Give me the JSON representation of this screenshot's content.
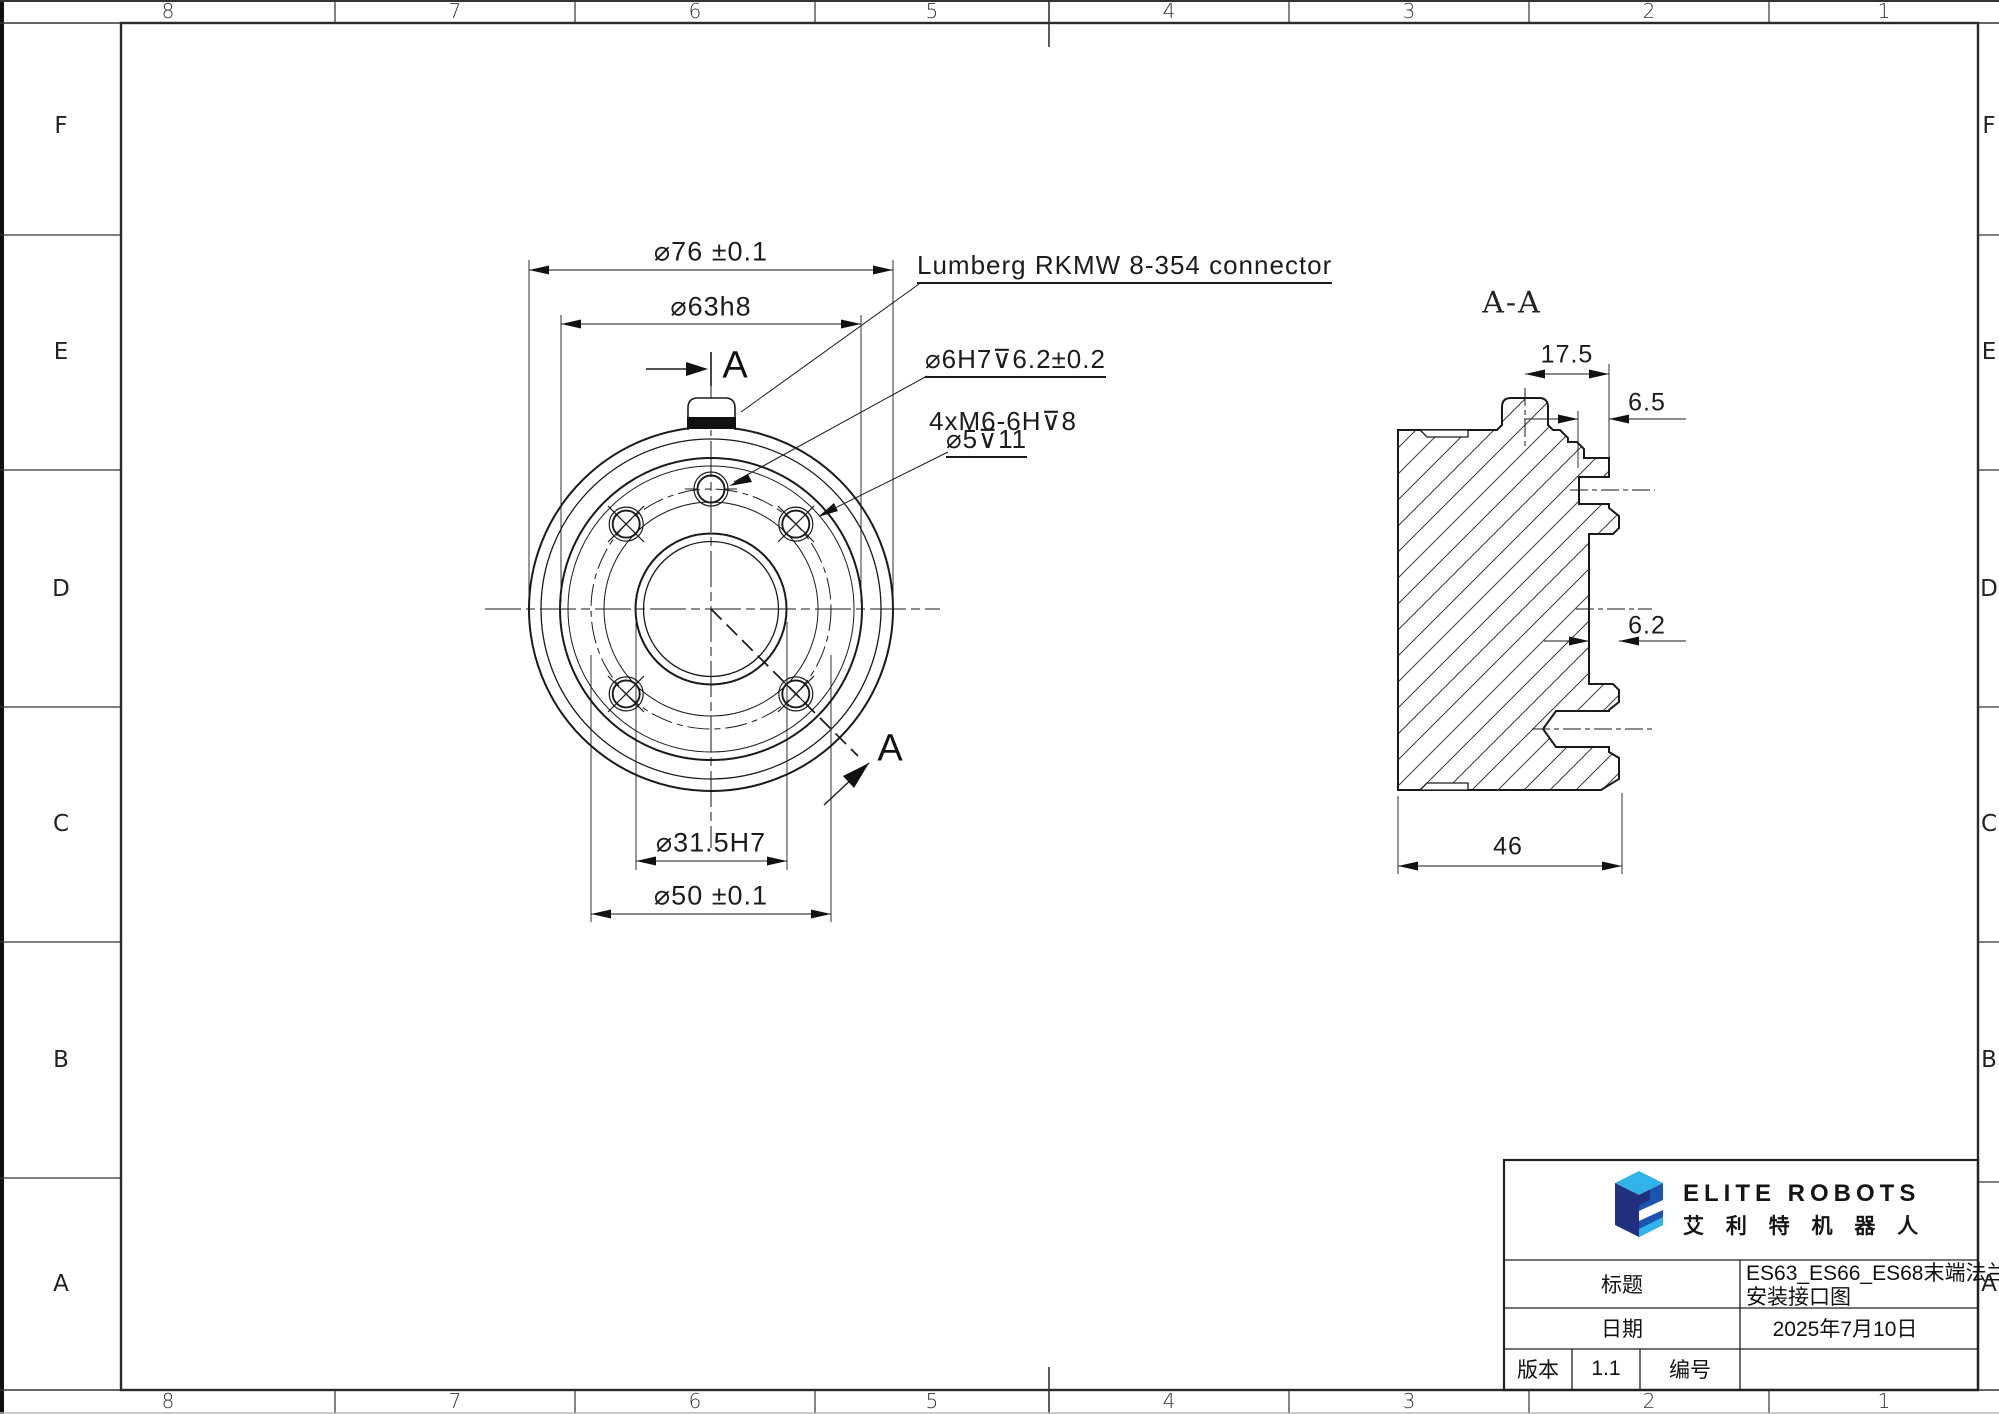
{
  "sheet": {
    "grid_top": [
      "8",
      "7",
      "6",
      "5",
      "4",
      "3",
      "2",
      "1"
    ],
    "grid_bottom": [
      "8",
      "7",
      "6",
      "5",
      "4",
      "3",
      "2",
      "1"
    ],
    "grid_left": [
      "F",
      "E",
      "D",
      "C",
      "B",
      "A"
    ],
    "grid_right": [
      "F",
      "E",
      "D",
      "C",
      "B",
      "A"
    ]
  },
  "front_view": {
    "dims": {
      "d76": "⌀76 ±0.1",
      "d63": "⌀63h8",
      "d315": "⌀31.5H7",
      "d50": "⌀50 ±0.1"
    },
    "callouts": {
      "lumberg": "Lumberg RKMW 8-354 connector",
      "dowel": "⌀6H7⊽6.2±0.2",
      "m6": "4xM6-6H⊽8",
      "drill": "⌀5⊽11"
    },
    "section_label_top": "A",
    "section_label_bottom": "A"
  },
  "section_view": {
    "title": "A-A",
    "dims": {
      "d175": "17.5",
      "d65": "6.5",
      "d62": "6.2",
      "d46": "46"
    }
  },
  "title_block": {
    "logo_en": "ELITE ROBOTS",
    "logo_cn": "艾 利 特 机 器 人",
    "title_label": "标题",
    "title_line1": "ES63_ES66_ES68末端法兰",
    "title_line2": "安装接口图",
    "date_label": "日期",
    "date_value": "2025年7月10日",
    "version_label": "版本",
    "version_value": "1.1",
    "number_label": "编号",
    "number_value": "",
    "colors": {
      "logo_light_blue": "#2FB3E8",
      "logo_navy": "#20307E",
      "logo_royal": "#1C55B0",
      "line": "#1a1a1a"
    }
  }
}
